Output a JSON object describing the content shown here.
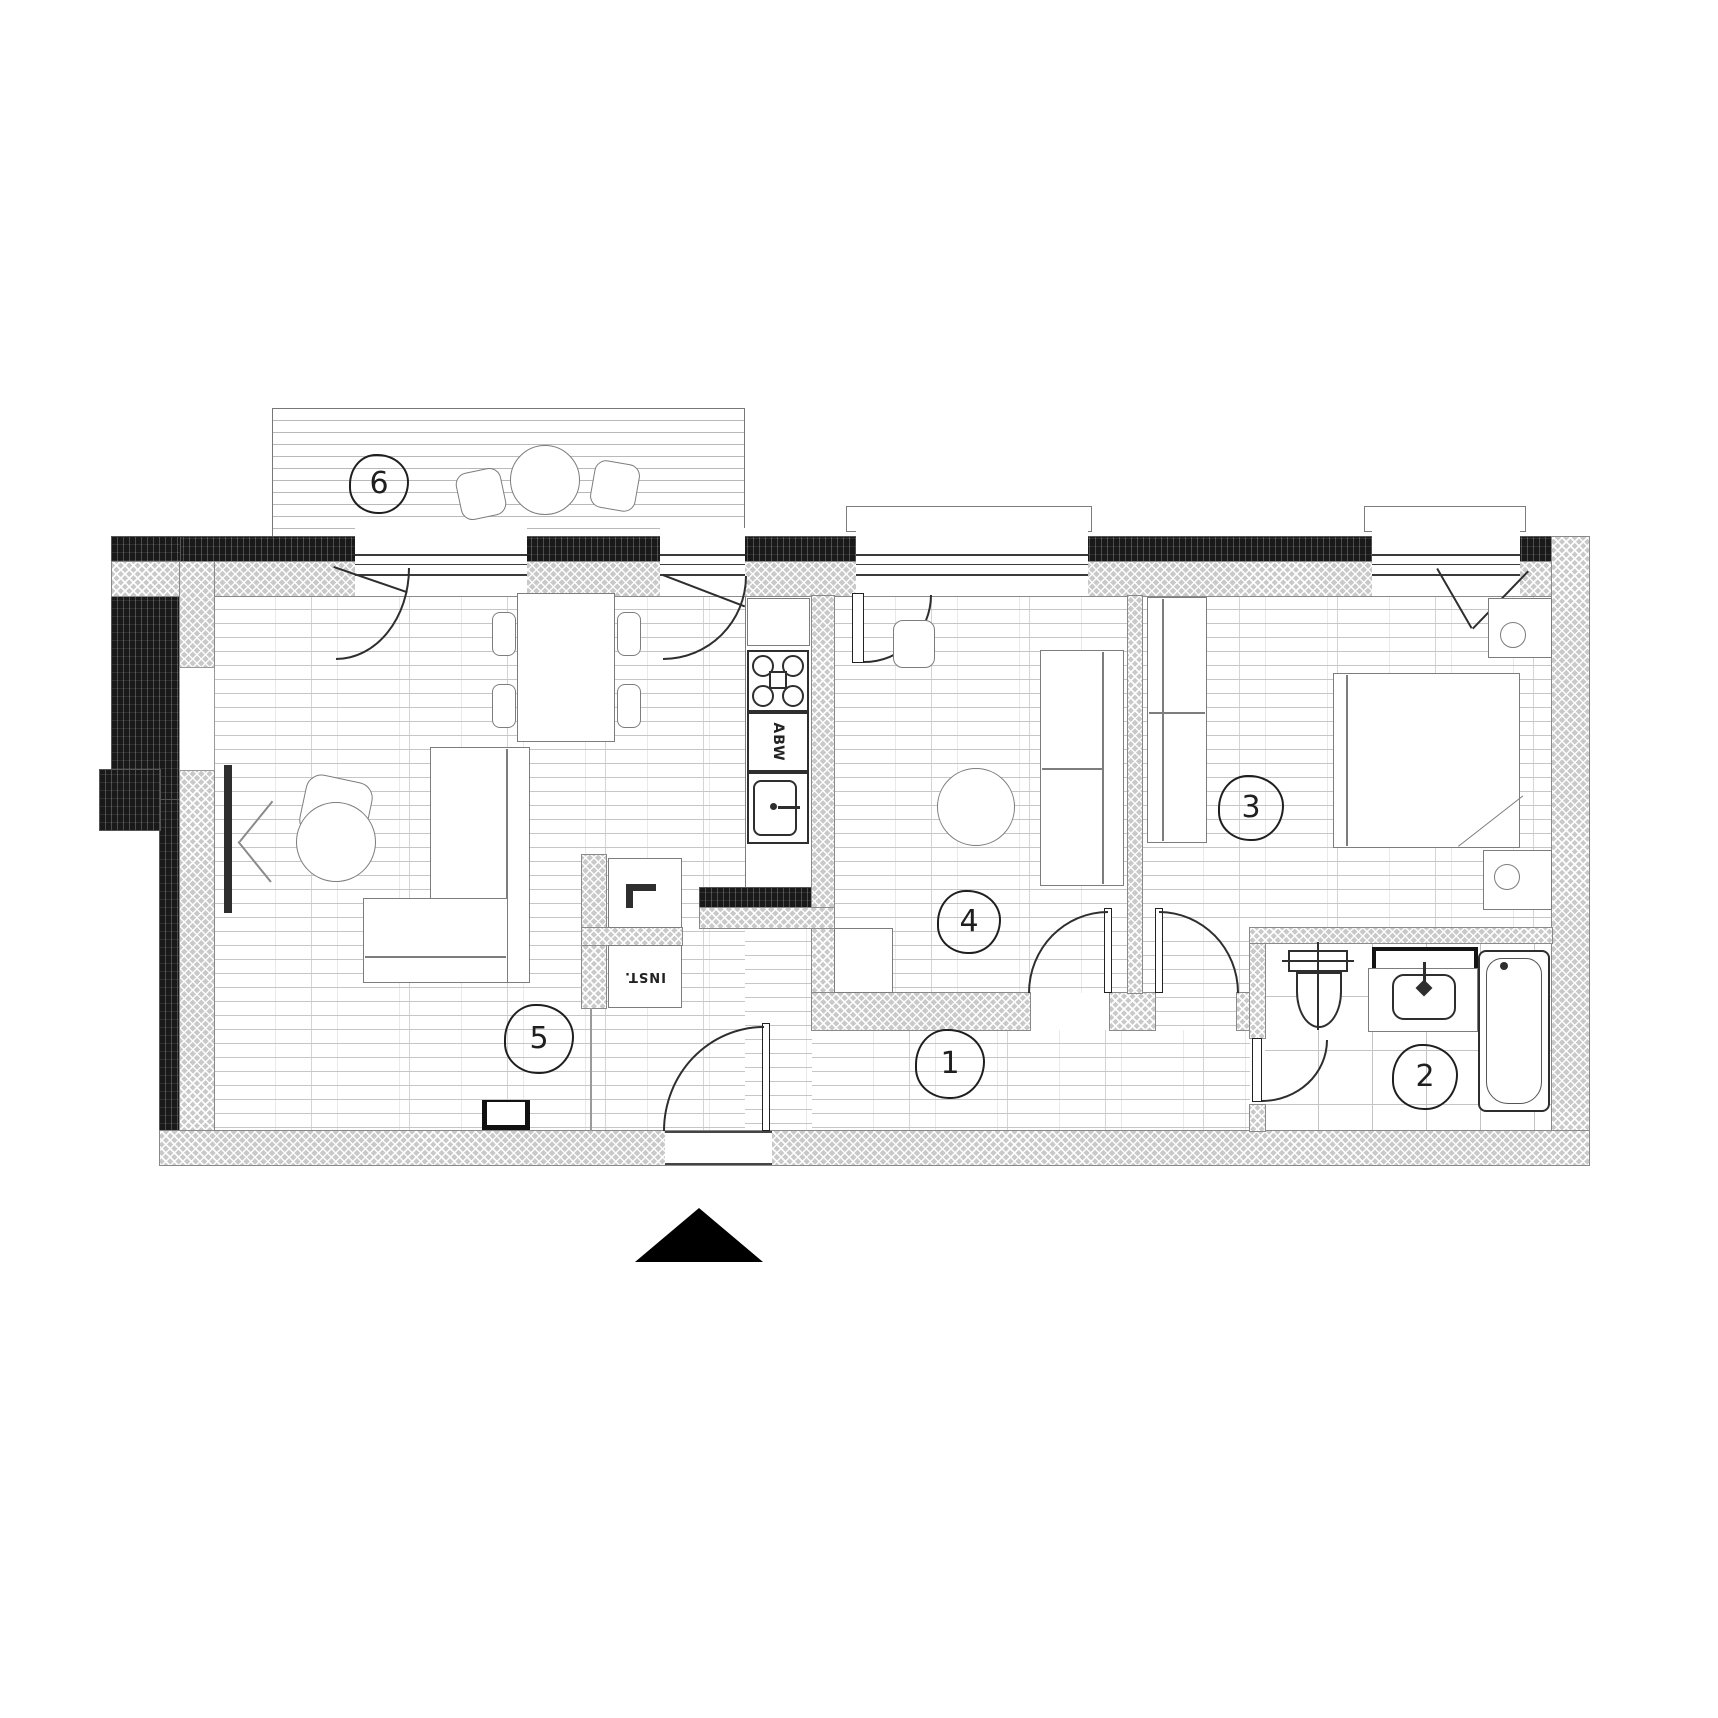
{
  "palette": {
    "paper": "#ffffff",
    "ink": "#1f1f1f",
    "wall_gray": "#c9c9c9",
    "insulation_black": "#191919",
    "furniture_gray": "#7d7d7d"
  },
  "rooms": {
    "r1": "1",
    "r2": "2",
    "r3": "3",
    "r4": "4",
    "r5": "5",
    "r6": "6"
  },
  "kitchen": {
    "appliance_label": "ABW"
  },
  "shaft": {
    "label": "INST."
  }
}
